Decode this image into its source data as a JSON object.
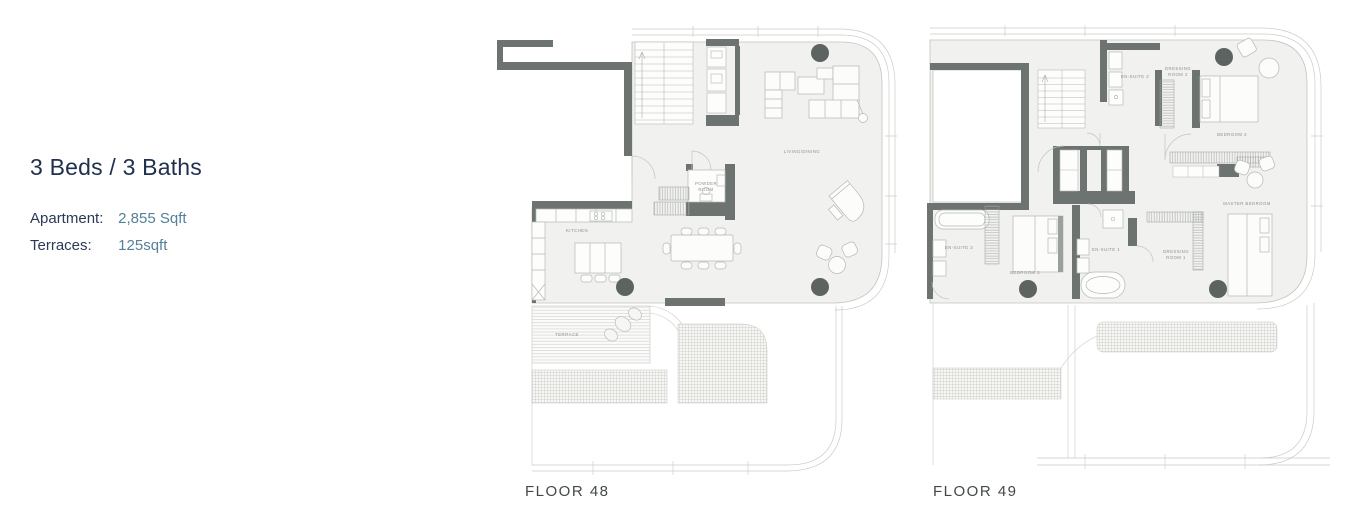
{
  "unit": {
    "title": "3 Beds / 3 Baths",
    "specs": [
      {
        "label": "Apartment:",
        "value": "2,855 Sqft"
      },
      {
        "label": "Terraces:",
        "value": "125sqft"
      }
    ]
  },
  "floor48": {
    "caption": "FLOOR 48",
    "rooms": {
      "living_dining": "LIVING/DINING",
      "kitchen": "KITCHEN",
      "powder_room_line1": "POWDER",
      "powder_room_line2": "ROOM",
      "terrace": "TERRACE"
    }
  },
  "floor49": {
    "caption": "FLOOR 49",
    "rooms": {
      "en_suite_2": "EN-SUITE 2",
      "dressing_room_2_line1": "DRESSING",
      "dressing_room_2_line2": "ROOM 2",
      "bedroom_2": "BEDROOM 2",
      "master_bedroom": "MASTER BEDROOM",
      "en_suite_3": "EN-SUITE 3",
      "bedroom_3": "BEDROOM 3",
      "en_suite_1": "EN-SUITE 1",
      "dressing_room_1_line1": "DRESSING",
      "dressing_room_1_line2": "ROOM 1"
    }
  },
  "colors": {
    "heading": "#20304f",
    "spec_label": "#2a3a58",
    "spec_value": "#54809a",
    "wall": "#6d7371",
    "floor_fill": "#f1f1ef",
    "line": "#c6c9c5",
    "column": "#5d6361",
    "room_label": "#8d928f",
    "caption": "#43484a"
  }
}
